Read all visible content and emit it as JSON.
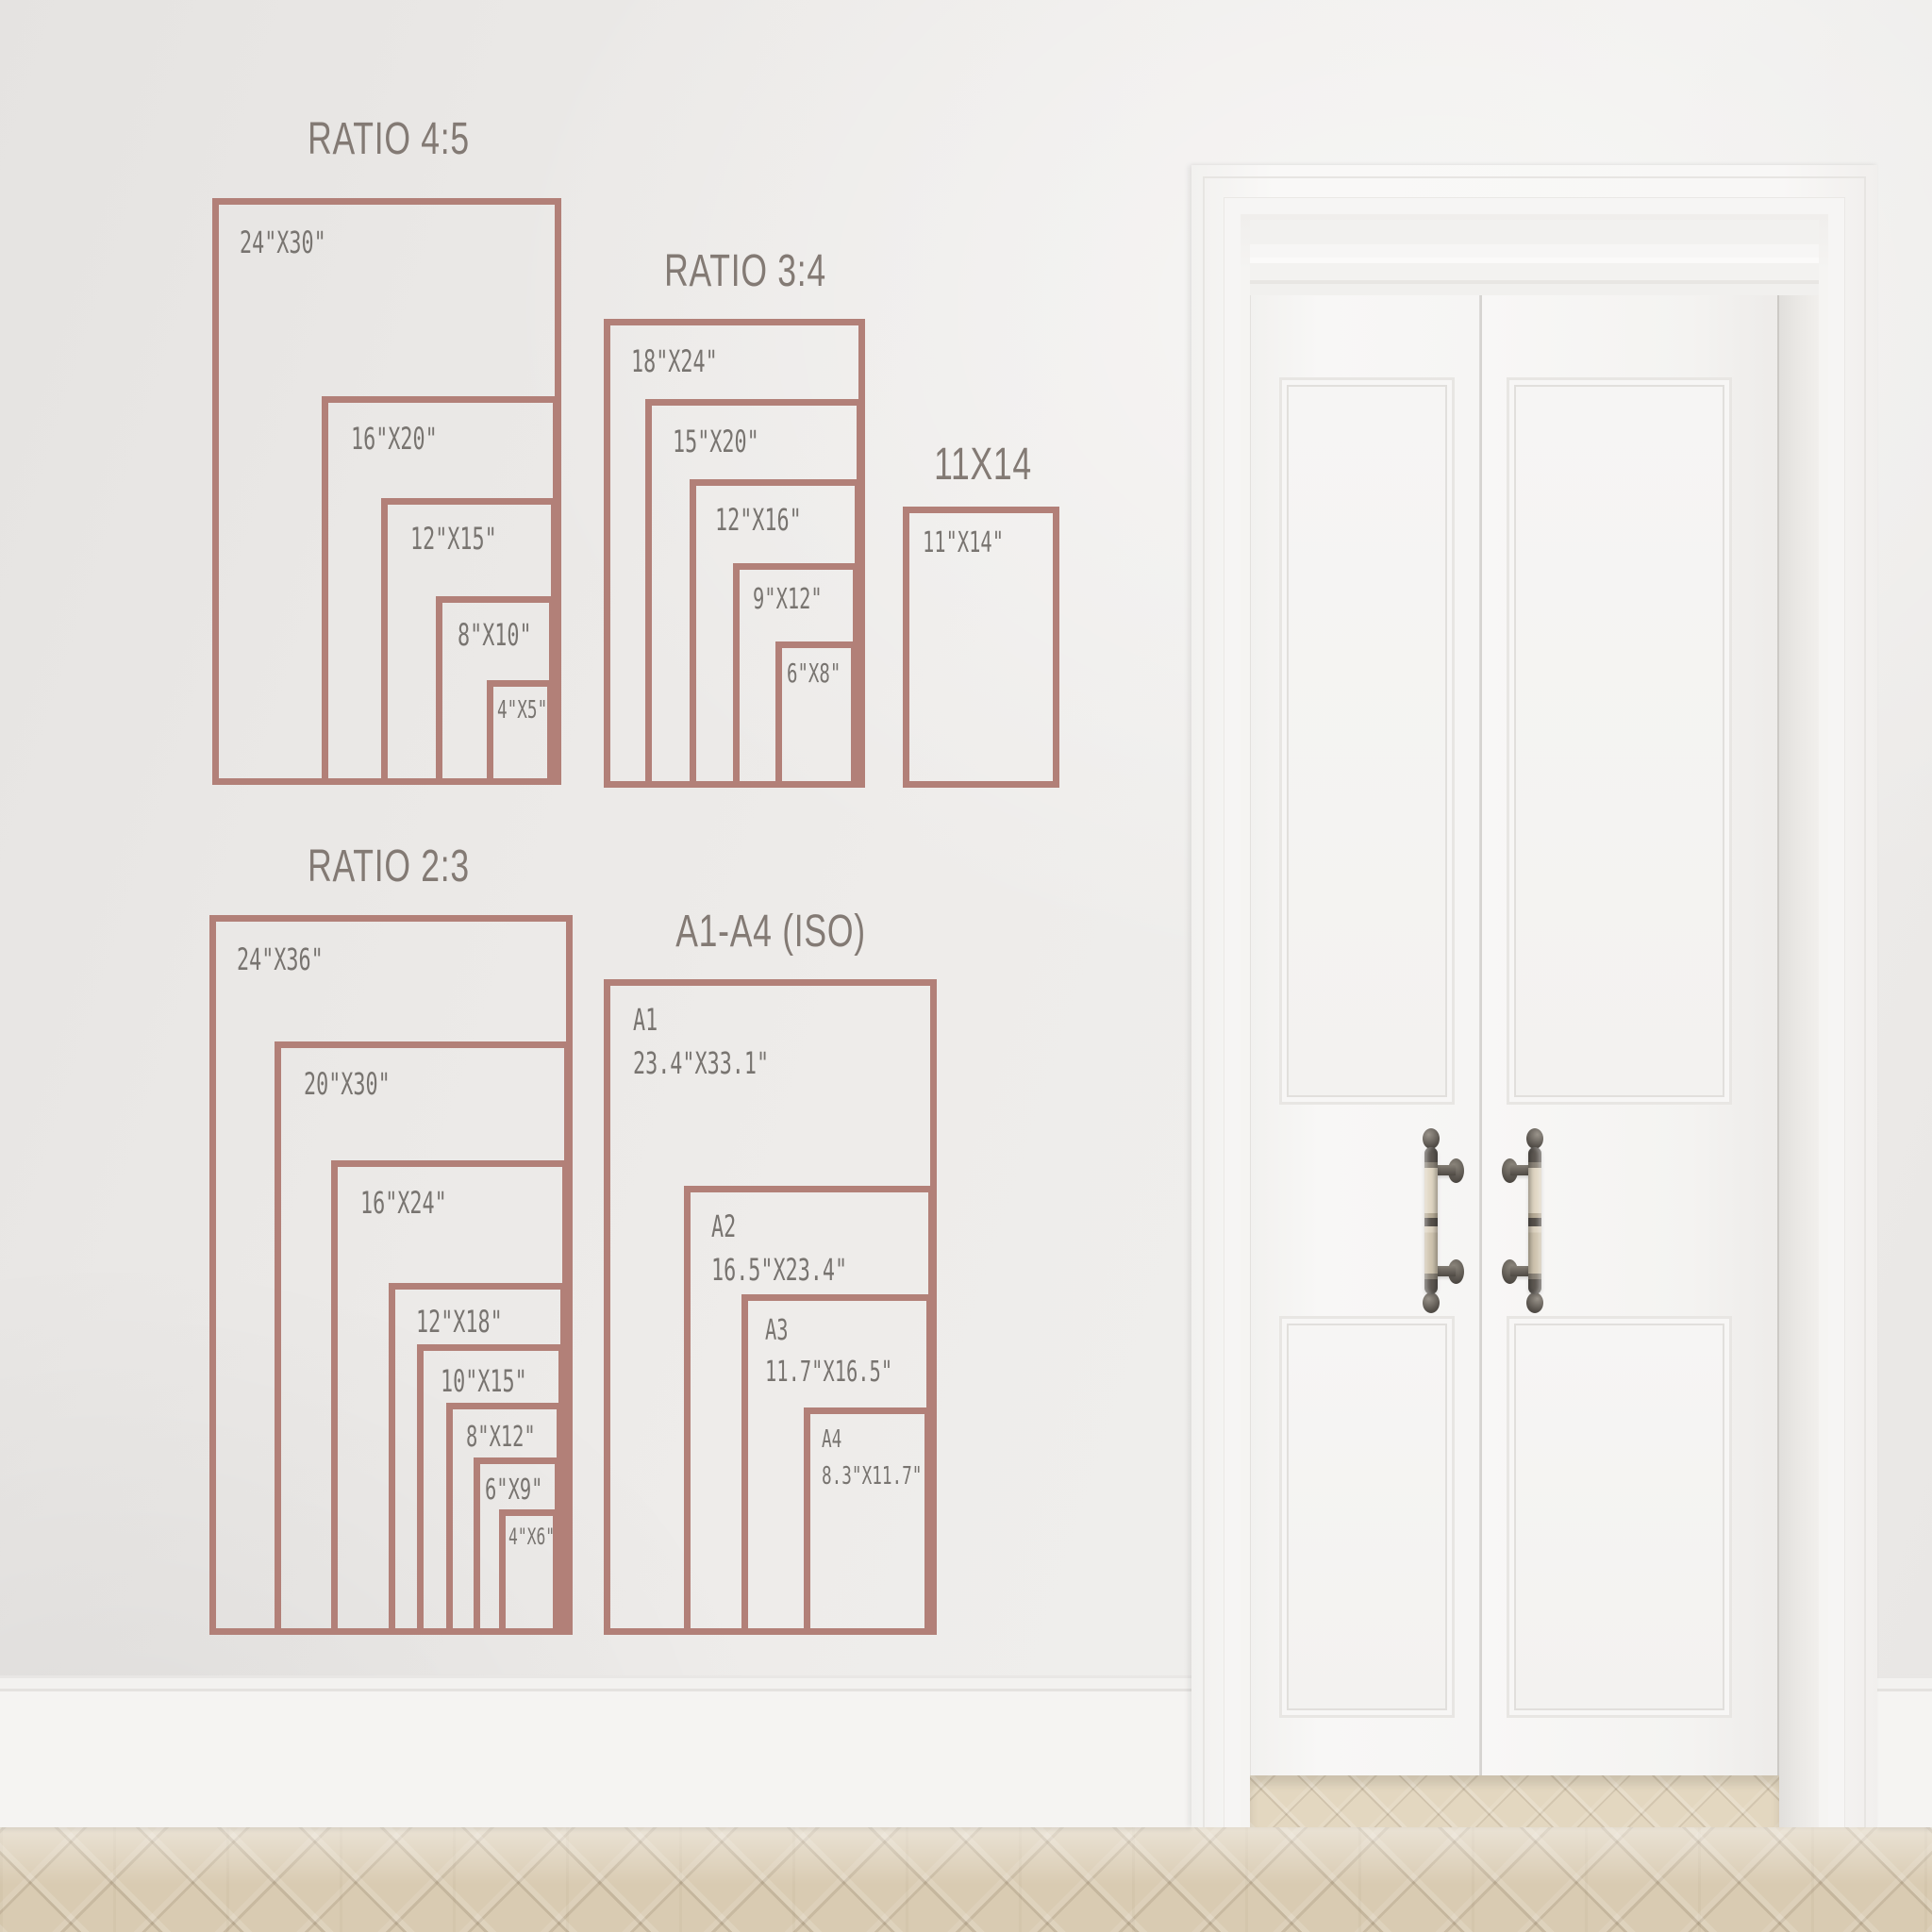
{
  "colors": {
    "accent_outline": "#b28078",
    "label_text": "#787470",
    "title_text": "#837a74",
    "wall": "#ebe9e7",
    "floor_wood": "#d9cbb2",
    "door_white": "#f6f5f4",
    "handle_metal": "#57524c",
    "handle_bone": "#ddd3c0"
  },
  "groups": [
    {
      "id": "ratio-4-5",
      "title": "RATIO 4:5",
      "boxes": [
        {
          "label": "24\"X30\""
        },
        {
          "label": "16\"X20\""
        },
        {
          "label": "12\"X15\""
        },
        {
          "label": "8\"X10\""
        },
        {
          "label": "4\"X5\""
        }
      ]
    },
    {
      "id": "ratio-3-4",
      "title": "RATIO 3:4",
      "boxes": [
        {
          "label": "18\"X24\""
        },
        {
          "label": "15\"X20\""
        },
        {
          "label": "12\"X16\""
        },
        {
          "label": "9\"X12\""
        },
        {
          "label": "6\"X8\""
        }
      ]
    },
    {
      "id": "s11x14",
      "title": "11X14",
      "boxes": [
        {
          "label": "11\"X14\""
        }
      ]
    },
    {
      "id": "ratio-2-3",
      "title": "RATIO 2:3",
      "boxes": [
        {
          "label": "24\"X36\""
        },
        {
          "label": "20\"X30\""
        },
        {
          "label": "16\"X24\""
        },
        {
          "label": "12\"X18\""
        },
        {
          "label": "10\"X15\""
        },
        {
          "label": "8\"X12\""
        },
        {
          "label": "6\"X9\""
        },
        {
          "label": "4\"X6\""
        }
      ]
    },
    {
      "id": "a-series",
      "title": "A1-A4 (ISO)",
      "boxes": [
        {
          "name": "A1",
          "label": "23.4\"X33.1\""
        },
        {
          "name": "A2",
          "label": "16.5\"X23.4\""
        },
        {
          "name": "A3",
          "label": "11.7\"X16.5\""
        },
        {
          "name": "A4",
          "label": "8.3\"X11.7\""
        }
      ]
    }
  ]
}
